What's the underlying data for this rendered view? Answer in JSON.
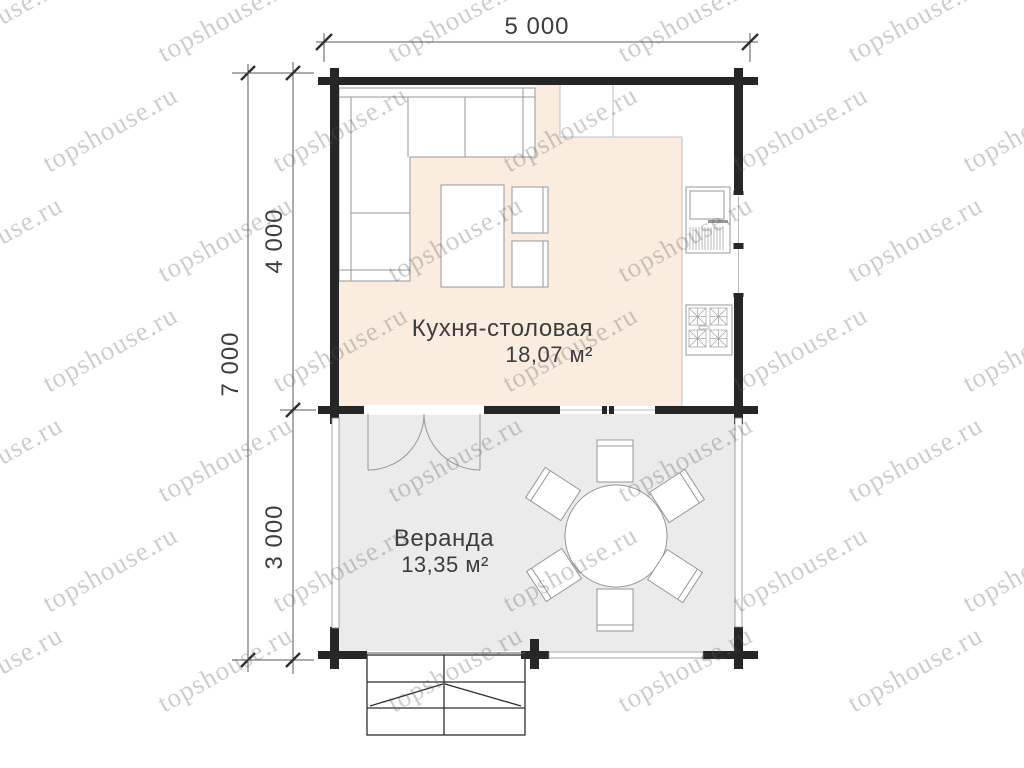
{
  "watermark": {
    "text": "topshouse.ru"
  },
  "dimensions": {
    "top_width": "5 000",
    "total_height": "7 000",
    "kitchen_depth": "4 000",
    "veranda_depth": "3 000"
  },
  "rooms": {
    "kitchen": {
      "name": "Кухня-столовая",
      "area": "18,07 м²"
    },
    "veranda": {
      "name": "Веранда",
      "area": "13,35 м²"
    }
  },
  "colors": {
    "wall": "#262626",
    "kitchen_floor": "#faecdf",
    "veranda_floor": "#ebebeb",
    "furniture_stroke": "#979797",
    "watermark": "#c4c4c4"
  }
}
